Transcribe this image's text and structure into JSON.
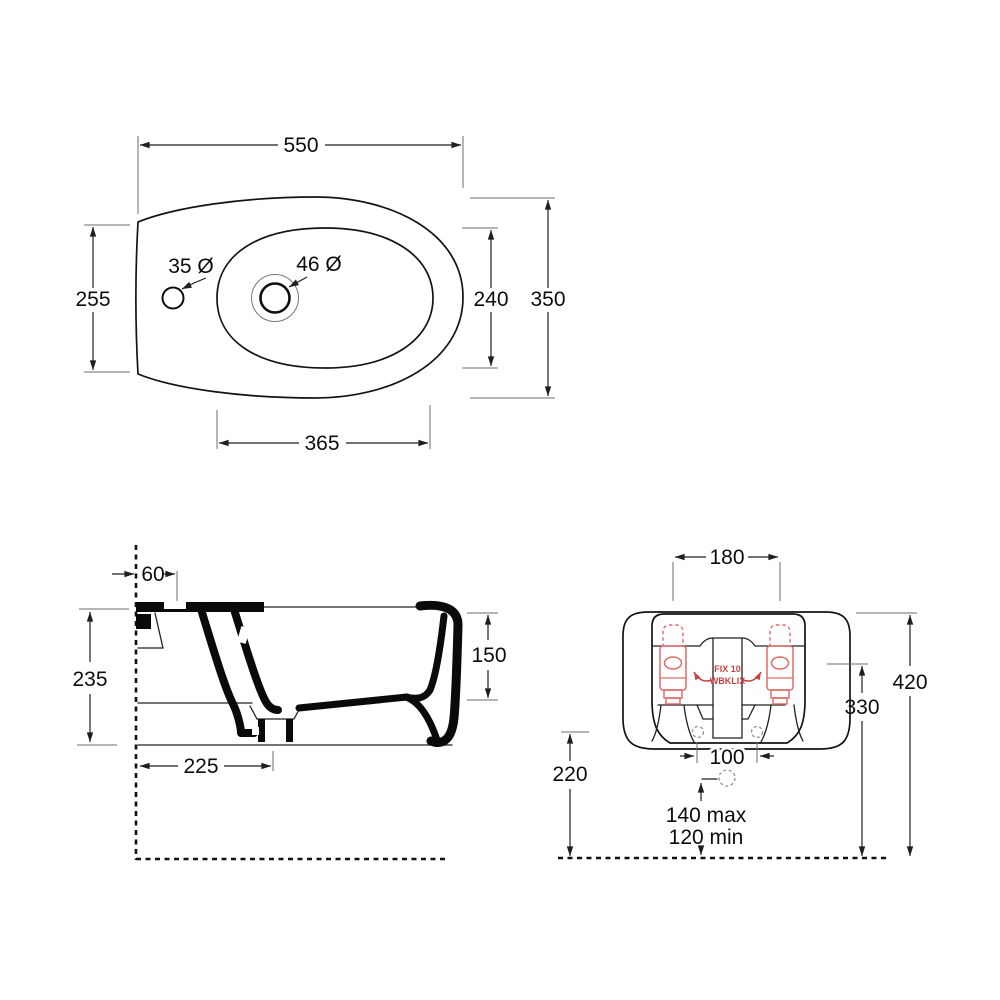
{
  "drawing": {
    "title": "bidet-technical-drawing",
    "views": {
      "top": {
        "label": "top-view",
        "dims": {
          "overall_width": "550",
          "overall_depth": "350",
          "left_depth": "255",
          "bowl_depth": "240",
          "bowl_width": "365",
          "tap_hole_diameter": "35 Ø",
          "drain_hole_diameter": "46 Ø"
        }
      },
      "side": {
        "label": "side-section-view",
        "dims": {
          "hole_offset_from_wall": "60",
          "body_height": "235",
          "inner_depth": "150",
          "drain_distance_from_wall": "225"
        }
      },
      "rear": {
        "label": "rear-view",
        "dims": {
          "fixing_bracket_centres": "180",
          "overall_height_from_floor": "420",
          "bracket_height_from_floor": "330",
          "fixing_hole_height": "220",
          "fixing_hole_centres": "100",
          "supply_height_max": "140 max",
          "supply_height_min": "120 min"
        },
        "fixing_kit": {
          "line1": "FIX 10",
          "line2": "WBKLIX"
        }
      }
    },
    "colors": {
      "line": "#141414",
      "extension_line": "#6e6e6e",
      "fixing_bracket_red": "#dd6d68",
      "fixing_text_red": "#c8433e",
      "background": "#ffffff"
    }
  }
}
